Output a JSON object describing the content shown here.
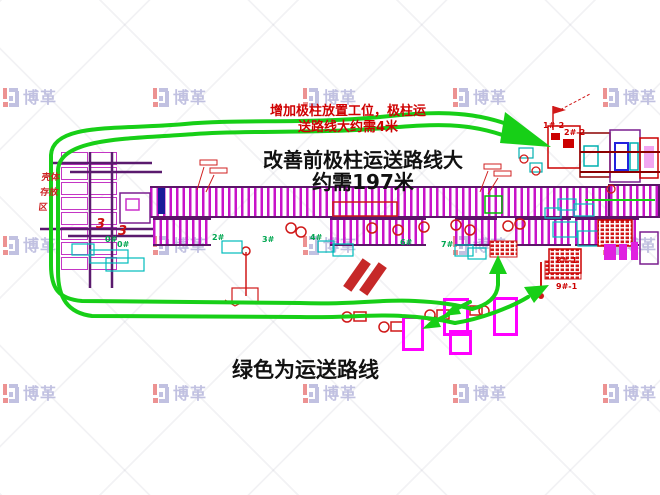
{
  "watermark": {
    "logo_text": "博革",
    "icon": "bg-logo-icon",
    "color_red": "#e97f7f",
    "color_lavender": "#b7b7dc",
    "grid_rows_y": [
      88,
      236,
      384
    ],
    "grid_cols_x": [
      3,
      153,
      303,
      453,
      603
    ]
  },
  "annotations": {
    "note_add_station": {
      "line1": "增加极柱放置工位，极柱运",
      "line2": "送路线大约需4米",
      "color": "#cf0000"
    },
    "main_note": {
      "line1": "改善前极柱运送路线大",
      "line2": "约需197米",
      "color": "#111111"
    },
    "legend_note": {
      "text": "绿色为运送路线",
      "color": "#111111"
    },
    "storage_area_label": {
      "line1": "壳体",
      "line2": "存放",
      "line3": "区",
      "color": "#cc2222"
    }
  },
  "route": {
    "color": "#17cf17",
    "meaning": "运送路线"
  },
  "diagram_labels": [
    {
      "text": "0#",
      "x": 105,
      "y": 236,
      "color": "#00a650",
      "cls": "station"
    },
    {
      "text": "0#",
      "x": 117,
      "y": 241,
      "color": "#00a650",
      "cls": "station"
    },
    {
      "text": "2#",
      "x": 212,
      "y": 234,
      "color": "#00a650",
      "cls": "station"
    },
    {
      "text": "3#",
      "x": 262,
      "y": 236,
      "color": "#00a650",
      "cls": "station"
    },
    {
      "text": "4#",
      "x": 310,
      "y": 234,
      "color": "#00a650",
      "cls": "station"
    },
    {
      "text": "6#",
      "x": 400,
      "y": 239,
      "color": "#00a650",
      "cls": "station"
    },
    {
      "text": "7#",
      "x": 441,
      "y": 241,
      "color": "#00a650",
      "cls": "station"
    },
    {
      "text": "1#-2",
      "x": 543,
      "y": 122,
      "color": "#cc0000",
      "cls": "machine"
    },
    {
      "text": "2#-2",
      "x": 564,
      "y": 129,
      "color": "#cc0000",
      "cls": "machine"
    },
    {
      "text": "8#-1",
      "x": 556,
      "y": 257,
      "color": "#cc0000",
      "cls": "machine"
    },
    {
      "text": "9#-1",
      "x": 556,
      "y": 283,
      "color": "#cc0000",
      "cls": "machine"
    },
    {
      "text": "3",
      "x": 96,
      "y": 218,
      "color": "#cc1111",
      "cls": "num"
    },
    {
      "text": "3",
      "x": 118,
      "y": 225,
      "color": "#cc1111",
      "cls": "num"
    }
  ]
}
